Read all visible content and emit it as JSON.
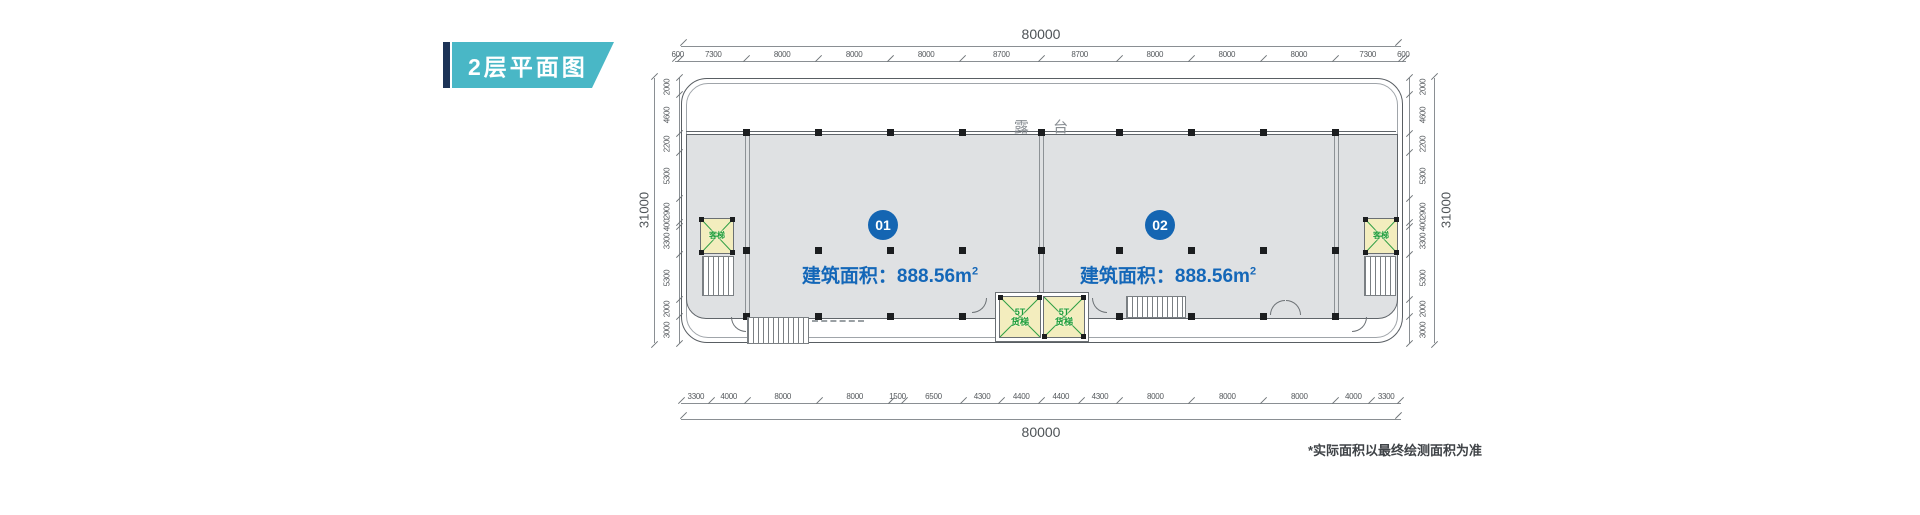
{
  "banner": {
    "title": "2层平面图"
  },
  "plan": {
    "terrace_label": "露 台",
    "units": [
      {
        "id": "01",
        "area_label": "建筑面积：",
        "area_value": "888.56",
        "area_unit_base": "m",
        "area_unit_sup": "2"
      },
      {
        "id": "02",
        "area_label": "建筑面积：",
        "area_value": "888.56",
        "area_unit_base": "m",
        "area_unit_sup": "2"
      }
    ],
    "passenger_elevator_label": "客梯",
    "freight_elevator": {
      "line1": "5T",
      "line2": "货梯"
    },
    "note": "*实际面积以最终绘测面积为准"
  },
  "dimensions": {
    "top": {
      "total": "80000",
      "segments": [
        600,
        7300,
        8000,
        8000,
        8000,
        8700,
        8700,
        8000,
        8000,
        8000,
        7300,
        600
      ]
    },
    "bottom": {
      "total": "80000",
      "segments": [
        3300,
        4000,
        8000,
        8000,
        1500,
        6500,
        4300,
        4400,
        4400,
        4300,
        8000,
        8000,
        8000,
        4000,
        3300
      ]
    },
    "left": {
      "total": "31000",
      "segments": [
        2000,
        4600,
        2200,
        5300,
        2900,
        400,
        3300,
        5300,
        2000,
        3000
      ]
    },
    "right": {
      "total": "31000",
      "segments": [
        2000,
        4600,
        2200,
        5300,
        2900,
        400,
        3300,
        5300,
        2000,
        3000
      ]
    }
  },
  "colors": {
    "accent_blue": "#1465b2",
    "banner_teal": "#49b7c6",
    "banner_navy": "#1c3357",
    "floor_gray": "#dfe1e3",
    "elevator_yellow": "#f3edbe",
    "elevator_green": "#2e9e44"
  }
}
